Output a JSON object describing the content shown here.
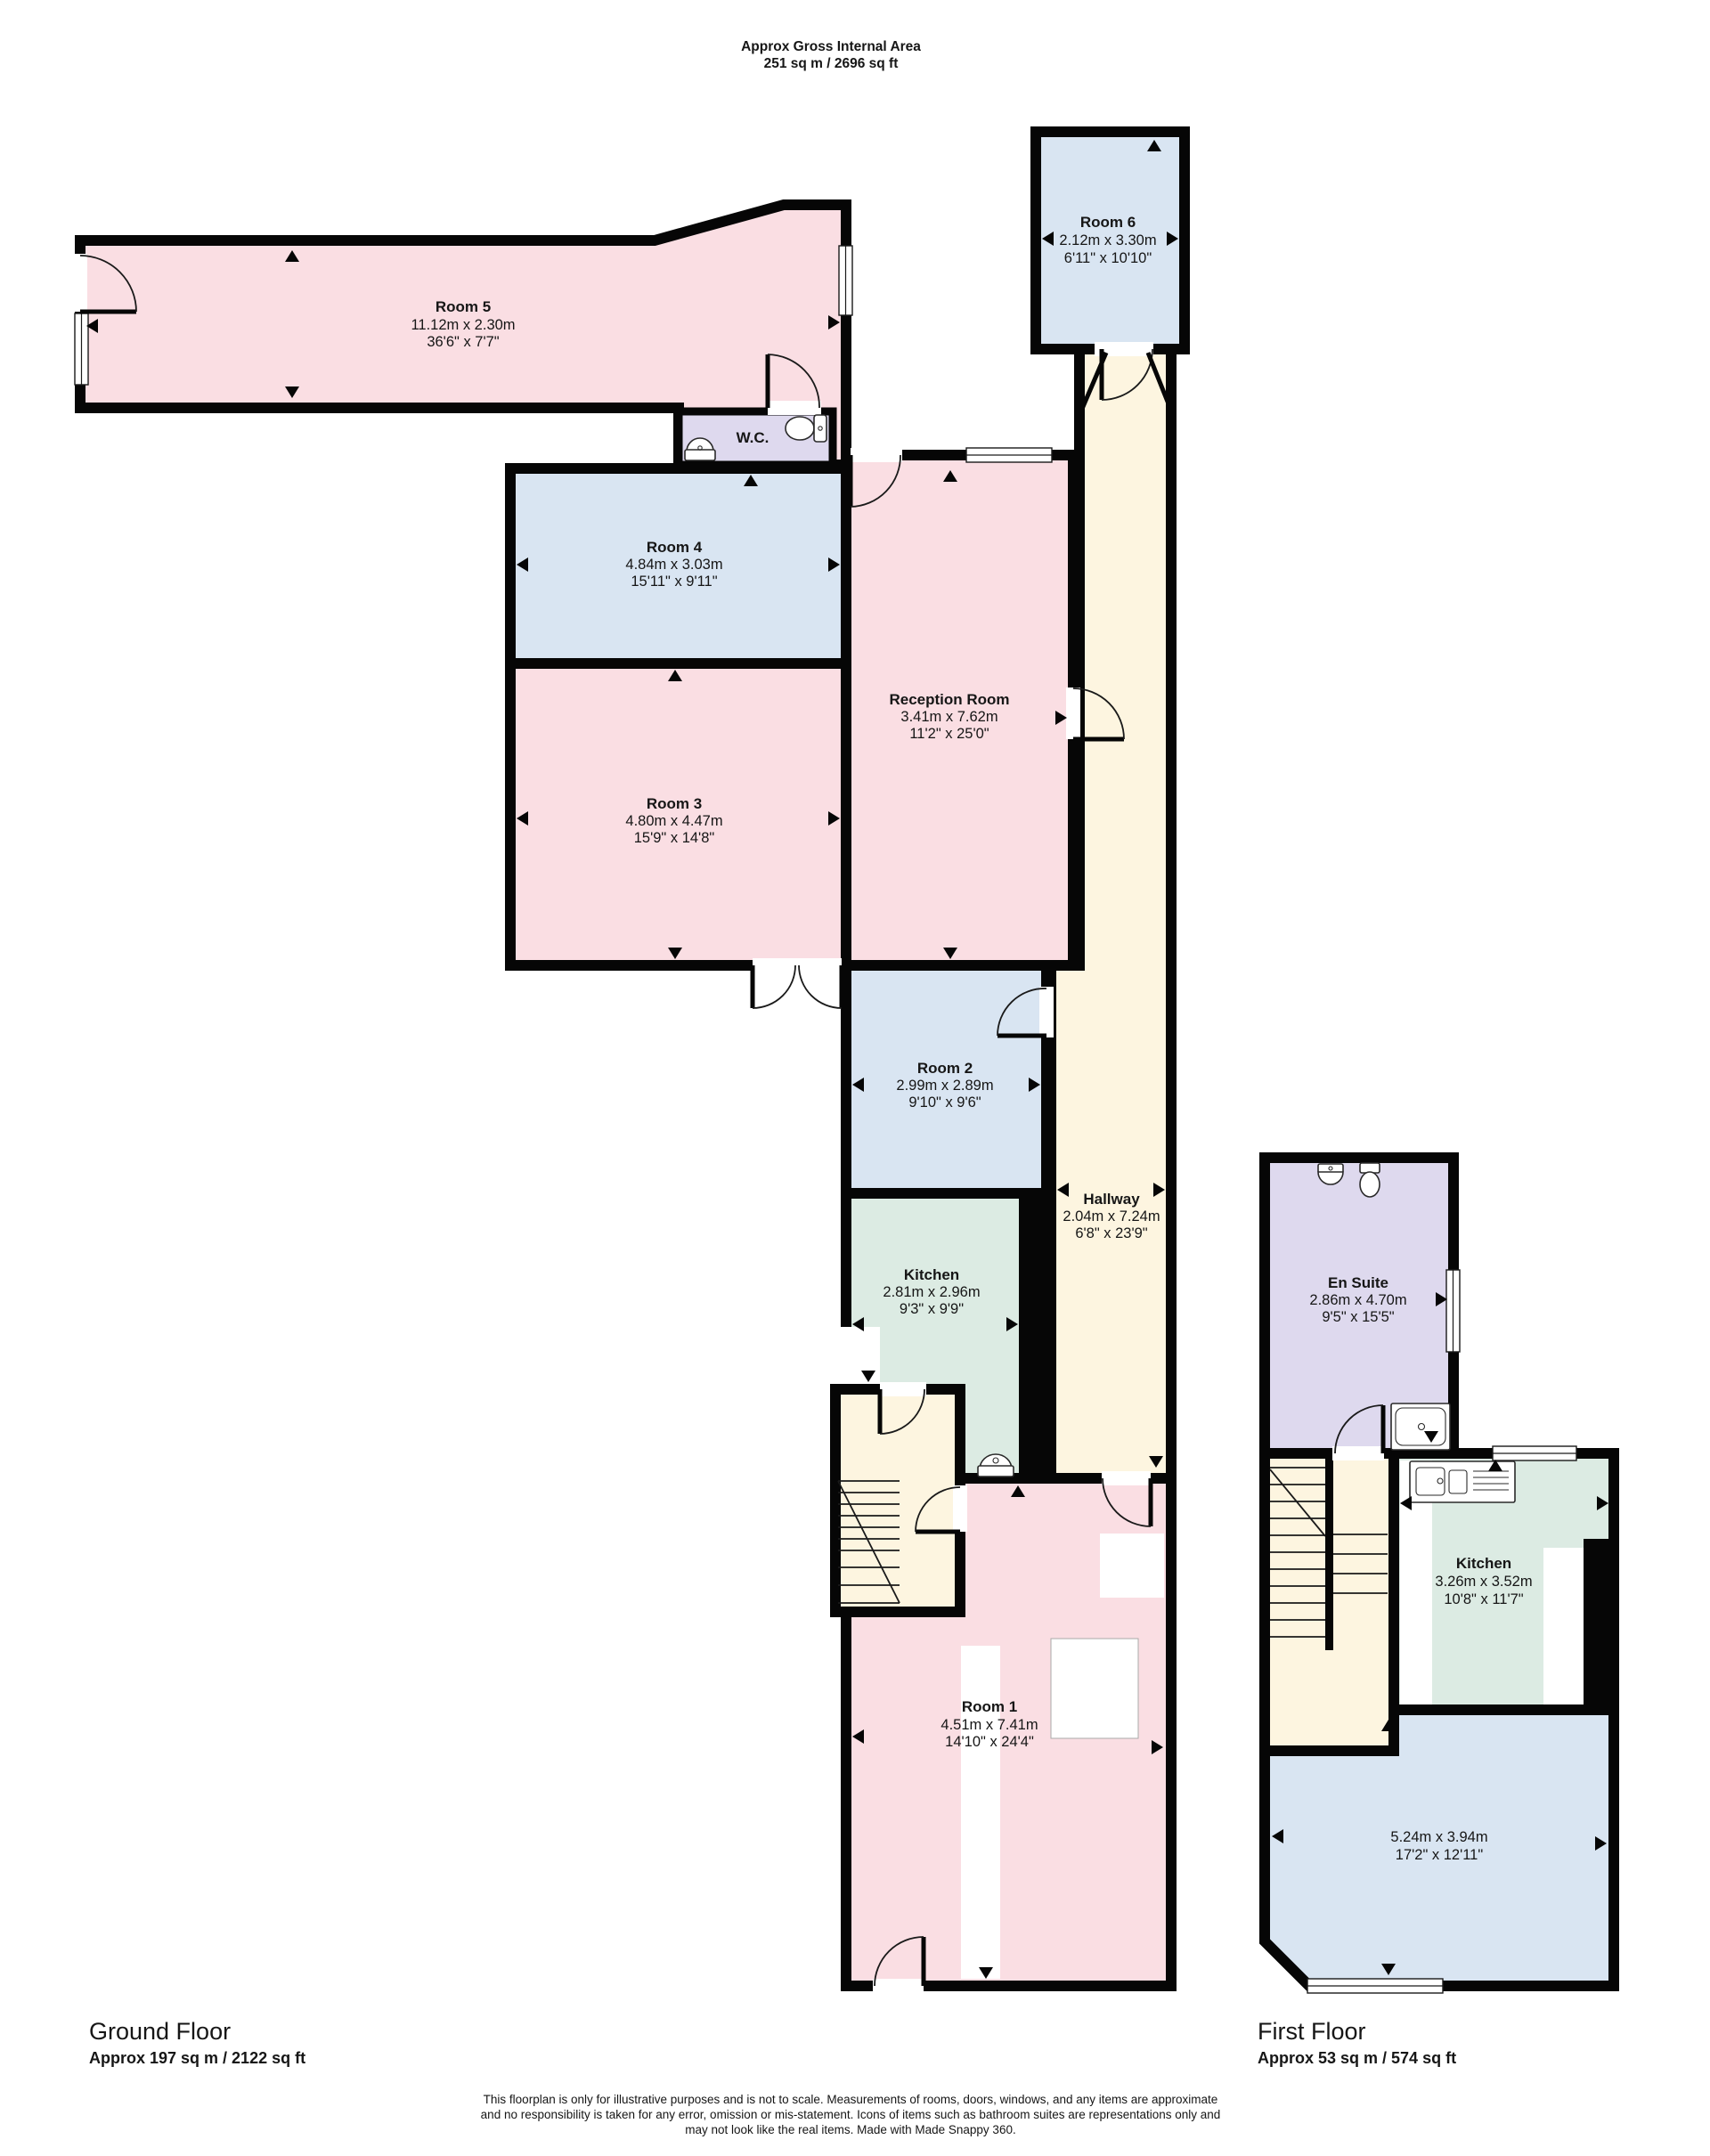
{
  "header": {
    "line1": "Approx Gross Internal Area",
    "line2": "251 sq m / 2696 sq ft"
  },
  "ground_floor": {
    "title": "Ground Floor",
    "area": "Approx 197 sq m / 2122 sq ft",
    "rooms": {
      "room5": {
        "name": "Room  5",
        "metric": "11.12m x 2.30m",
        "imperial": "36'6\" x 7'7\""
      },
      "room6": {
        "name": "Room 6",
        "metric": "2.12m x 3.30m",
        "imperial": "6'11\" x 10'10\""
      },
      "wc": {
        "name": "W.C."
      },
      "room4": {
        "name": "Room 4",
        "metric": "4.84m x 3.03m",
        "imperial": "15'11\" x 9'11\""
      },
      "reception": {
        "name": "Reception Room",
        "metric": "3.41m x 7.62m",
        "imperial": "11'2\" x 25'0\""
      },
      "room3": {
        "name": "Room 3",
        "metric": "4.80m x 4.47m",
        "imperial": "15'9\" x 14'8\""
      },
      "room2": {
        "name": "Room 2",
        "metric": "2.99m x 2.89m",
        "imperial": "9'10\" x 9'6\""
      },
      "hallway": {
        "name": "Hallway",
        "metric": "2.04m x 7.24m",
        "imperial": "6'8\" x 23'9\""
      },
      "kitchen": {
        "name": "Kitchen",
        "metric": "2.81m x 2.96m",
        "imperial": "9'3\" x 9'9\""
      },
      "room1": {
        "name": "Room 1",
        "metric": "4.51m x 7.41m",
        "imperial": "14'10\" x 24'4\""
      }
    }
  },
  "first_floor": {
    "title": "First Floor",
    "area": "Approx 53 sq m / 574 sq ft",
    "rooms": {
      "ensuite": {
        "name": "En Suite",
        "metric": "2.86m x 4.70m",
        "imperial": "9'5\" x 15'5\""
      },
      "kitchen": {
        "name": "Kitchen",
        "metric": "3.26m x 3.52m",
        "imperial": "10'8\" x 11'7\""
      },
      "bedroom": {
        "metric": "5.24m x 3.94m",
        "imperial": "17'2\" x 12'11\""
      }
    }
  },
  "footer": {
    "line1": "This floorplan is only for illustrative purposes and is not to scale. Measurements of rooms, doors, windows, and any items are approximate",
    "line2": "and no responsibility is taken for any error, omission or mis-statement. Icons of items such as bathroom suites are representations only and",
    "line3": "may not look like the real items. Made with Made Snappy 360."
  },
  "colors": {
    "room_pink": "#fadee3",
    "room_blue": "#d9e5f2",
    "room_lavender": "#ded9ee",
    "room_cream": "#fdf5e0",
    "room_mint": "#dcebe3",
    "wall": "#060606"
  }
}
